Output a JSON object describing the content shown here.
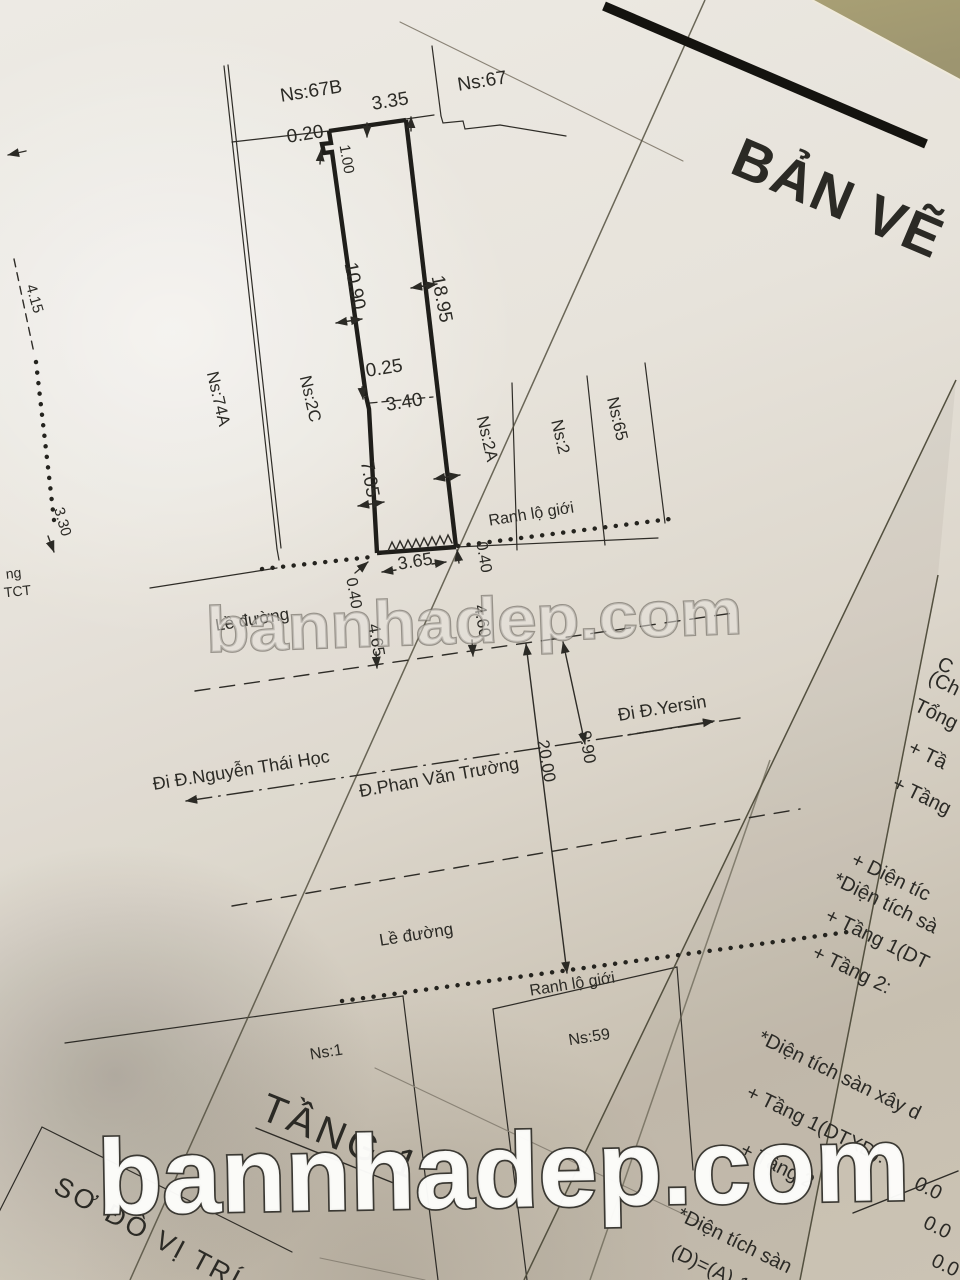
{
  "title": "BẢN VẼ",
  "watermark": {
    "center": "bannhadep.com",
    "bottom": "bannhadep.com"
  },
  "parcels": {
    "ns67b": "Ns:67B",
    "ns67": "Ns:67",
    "ns74a": "Ns:74A",
    "ns2c": "Ns:2C",
    "ns2a": "Ns:2A",
    "ns2": "Ns:2",
    "ns65": "Ns:65",
    "ns1": "Ns:1",
    "ns59": "Ns:59"
  },
  "dimensions": {
    "top_width": "3.35",
    "notch": "0.20",
    "inset": "1.00",
    "left_upper": "10.90",
    "right_side": "18.95",
    "step": "0.25",
    "mid_width": "3.40",
    "left_lower": "7.05",
    "bottom_width": "3.65",
    "offset_left": "0.40",
    "offset_right": "0.40",
    "setback_left": "4.65",
    "setback_right": "4.60",
    "edge_a": "4.15",
    "edge_b": "3.30",
    "road_width": "20.00",
    "half_width": "9.90"
  },
  "streets": {
    "nguyen_thai_hoc": "Đi Đ.Nguyễn Thái Học",
    "phan_van_truong": "Đ.Phan Văn Trường",
    "yersin": "Đi Đ.Yersin"
  },
  "labels": {
    "ranh_lo_gioi_1": "Ranh lộ giới",
    "ranh_lo_gioi_2": "Ranh lộ giới",
    "le_duong_1": "Lề đường",
    "le_duong_2": "Lề đường",
    "tang_1": "TẦNG 1",
    "so_do_vi_tri": "SƠ ĐỒ VỊ TRÍ",
    "edge_fragment_1": "ng",
    "edge_fragment_2": "TCT"
  },
  "side_panel": {
    "lines": [
      "C",
      "(Ch",
      "Tổng",
      "+ Tầ",
      "+ Tầng",
      "+ Diện tíc",
      "*Diện tích sà",
      "+ Tầng 1(DT",
      "+ Tầng 2:",
      "*Diện tích sàn xây d",
      "+ Tầng 1(DTXD):",
      "+ Tầng 2",
      "0.0",
      "0.0",
      "0.0",
      "*Diện tích sàn",
      "(D)=(A)-1("
    ]
  }
}
